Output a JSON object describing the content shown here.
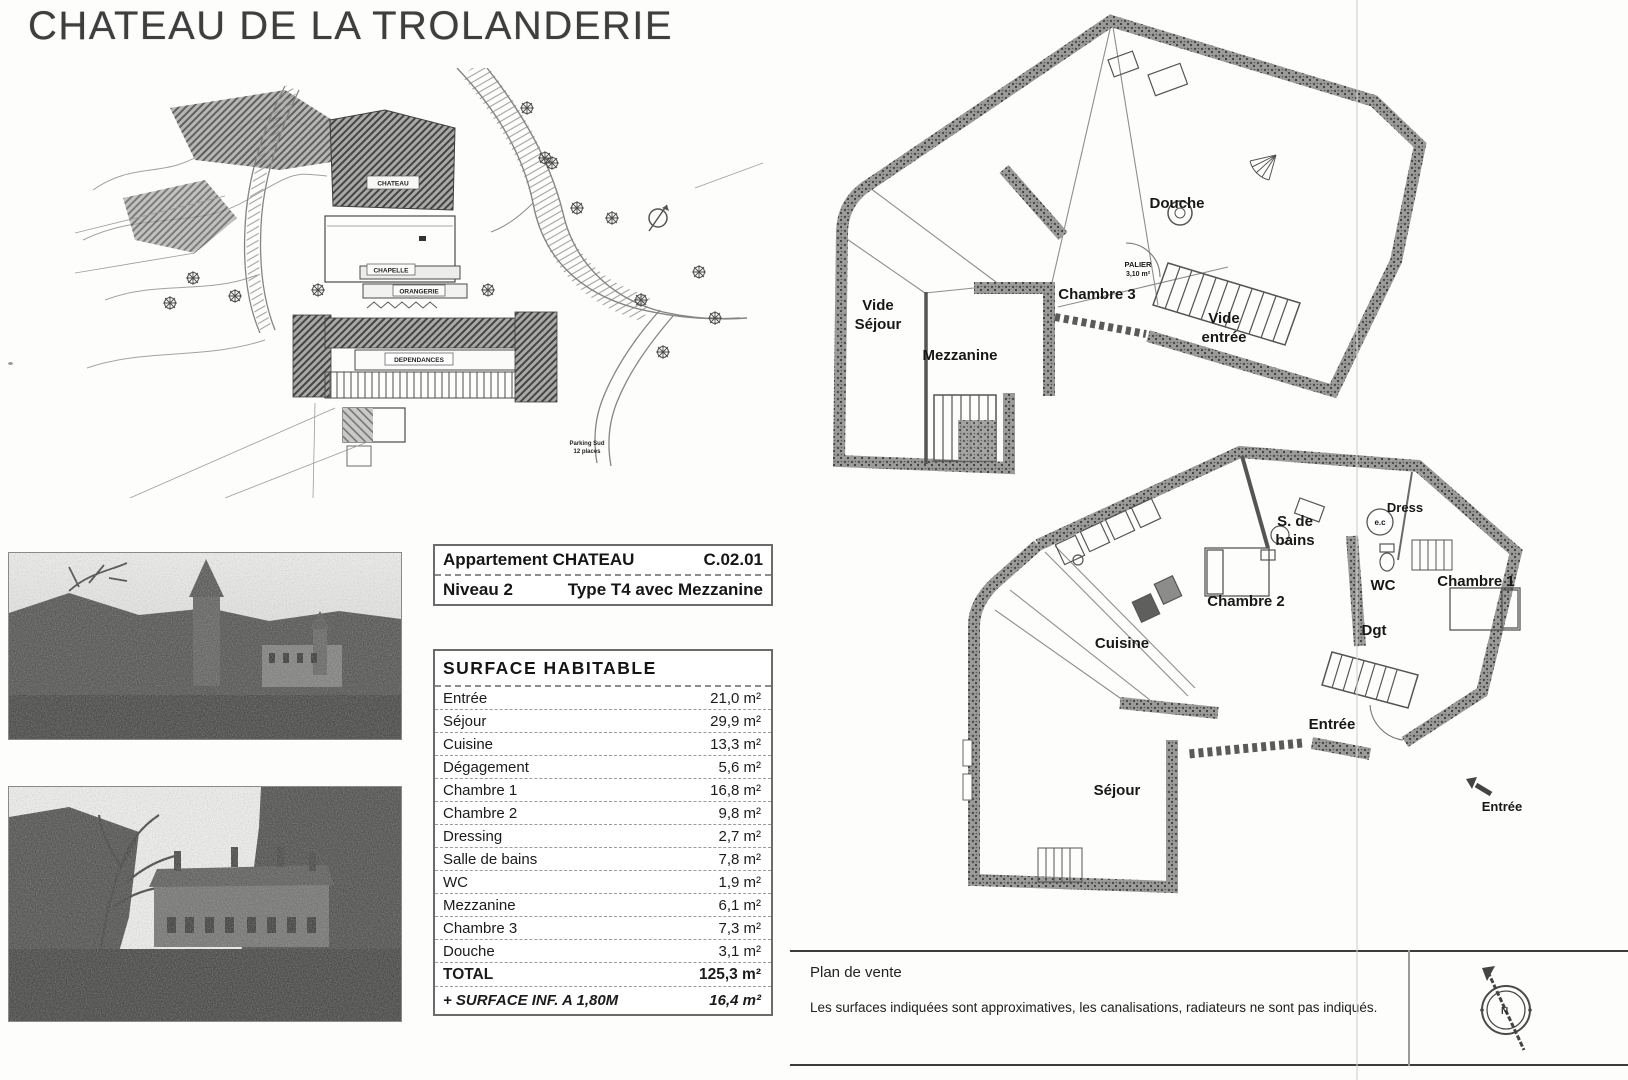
{
  "page": {
    "title": "CHATEAU DE LA TROLANDERIE"
  },
  "site_plan": {
    "labels": {
      "chateau": "CHATEAU",
      "chapelle": "CHAPELLE",
      "orangerie": "ORANGERIE",
      "dependances": "DEPENDANCES",
      "parking_1": "Parking Sud",
      "parking_2": "12 places"
    }
  },
  "info_table": {
    "rows": [
      {
        "left": "Appartement CHATEAU",
        "right": "C.02.01"
      },
      {
        "left": "Niveau 2",
        "right": "Type T4 avec Mezzanine"
      }
    ]
  },
  "surface_table": {
    "title": "SURFACE  HABITABLE",
    "rows": [
      {
        "label": "Entrée",
        "value": "21,0 m²"
      },
      {
        "label": "Séjour",
        "value": "29,9 m²"
      },
      {
        "label": "Cuisine",
        "value": "13,3 m²"
      },
      {
        "label": "Dégagement",
        "value": "5,6 m²"
      },
      {
        "label": "Chambre 1",
        "value": "16,8 m²"
      },
      {
        "label": "Chambre 2",
        "value": "9,8 m²"
      },
      {
        "label": "Dressing",
        "value": "2,7 m²"
      },
      {
        "label": "Salle de bains",
        "value": "7,8 m²"
      },
      {
        "label": "WC",
        "value": "1,9 m²"
      },
      {
        "label": "Mezzanine",
        "value": "6,1 m²"
      },
      {
        "label": "Chambre 3",
        "value": "7,3 m²"
      },
      {
        "label": "Douche",
        "value": "3,1 m²"
      }
    ],
    "total": {
      "label": "TOTAL",
      "value": "125,3 m²"
    },
    "extra": {
      "label": "+ SURFACE INF. A 1,80M",
      "value": "16,4 m²"
    }
  },
  "plans": {
    "upper": {
      "labels": {
        "douche": "Douche",
        "chambre3": "Chambre 3",
        "vide_sejour_1": "Vide",
        "vide_sejour_2": "Séjour",
        "mezzanine": "Mezzanine",
        "vide_entree_1": "Vide",
        "vide_entree_2": "entrée",
        "palier": "PALIER",
        "palier_area": "3,10 m²"
      }
    },
    "lower": {
      "labels": {
        "sdb_1": "S. de",
        "sdb_2": "bains",
        "dress": "Dress",
        "ec": "e.c",
        "chambre1": "Chambre 1",
        "chambre2": "Chambre 2",
        "wc": "WC",
        "dgt": "Dgt",
        "cuisine": "Cuisine",
        "entree": "Entrée",
        "sejour": "Séjour",
        "entree_ext": "Entrée"
      }
    }
  },
  "footer": {
    "title": "Plan de vente",
    "disclaimer": "Les surfaces indiquées sont approximatives, les canalisations, radiateurs ne sont pas indiqués.",
    "compass_n": "N"
  }
}
